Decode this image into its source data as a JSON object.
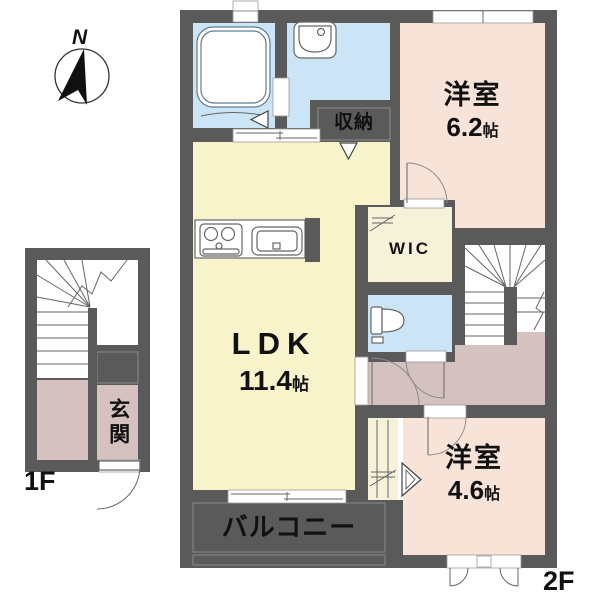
{
  "plan": {
    "compass": {
      "label": "N",
      "icon": "compass-north-icon"
    },
    "floor_1f": {
      "label": "1F",
      "entrance": {
        "label": "玄関"
      },
      "features": [
        "stairs-icon",
        "entrance-door-icon"
      ]
    },
    "floor_2f": {
      "label": "2F",
      "ldk": {
        "label": "LDK",
        "size_value": "11.4",
        "size_unit": "帖"
      },
      "western_room_1": {
        "label": "洋室",
        "size_value": "6.2",
        "size_unit": "帖"
      },
      "western_room_2": {
        "label": "洋室",
        "size_value": "4.6",
        "size_unit": "帖"
      },
      "wic": {
        "label": "WIC"
      },
      "storage": {
        "label": "収納"
      },
      "balcony": {
        "label": "バルコニー"
      },
      "features": [
        "bathtub-icon",
        "washbasin-icon",
        "toilet-icon",
        "stove-icon",
        "kitchen-sink-icon",
        "stairs-icon",
        "sliding-window-icon",
        "casement-window-icon"
      ]
    },
    "colors": {
      "wall": "#5a5a5a",
      "wet": "#cbe5f7",
      "ldk": "#f7f4cb",
      "west": "#f7e3d7",
      "hall": "#d6c1c1",
      "closet": "#f6f1d9"
    }
  }
}
